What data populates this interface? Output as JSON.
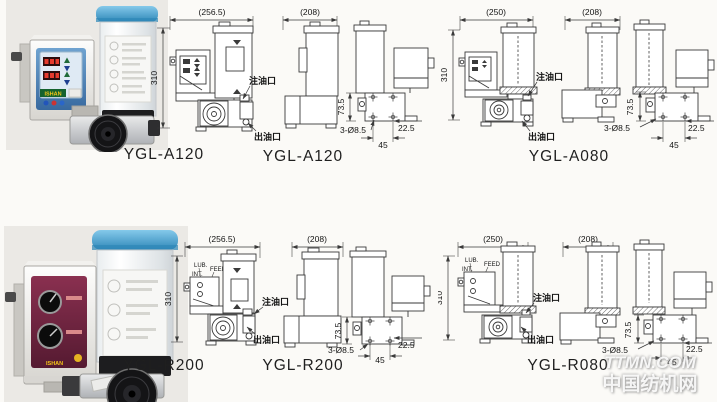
{
  "brand": "ISHAN",
  "watermark": {
    "line1": "TTMN.COM",
    "line2": "中国纺机网"
  },
  "ports": {
    "inlet": "注油口",
    "outlet": "出油口"
  },
  "knob_labels": {
    "lub": "LUB.",
    "int": "INT.",
    "feed": "FEED"
  },
  "models": {
    "a120": "YGL-A120",
    "a080": "YGL-A080",
    "r200": "YGL-R200",
    "r080": "YGL-R080"
  },
  "dims": {
    "front_width_large": "(256.5)",
    "front_width_small": "(250)",
    "side_width": "(208)",
    "height": "310",
    "flange_height": "73.5",
    "mount_holes": "3-Ø8.5",
    "edge_offset": "22.5",
    "hole_pitch": "45"
  }
}
